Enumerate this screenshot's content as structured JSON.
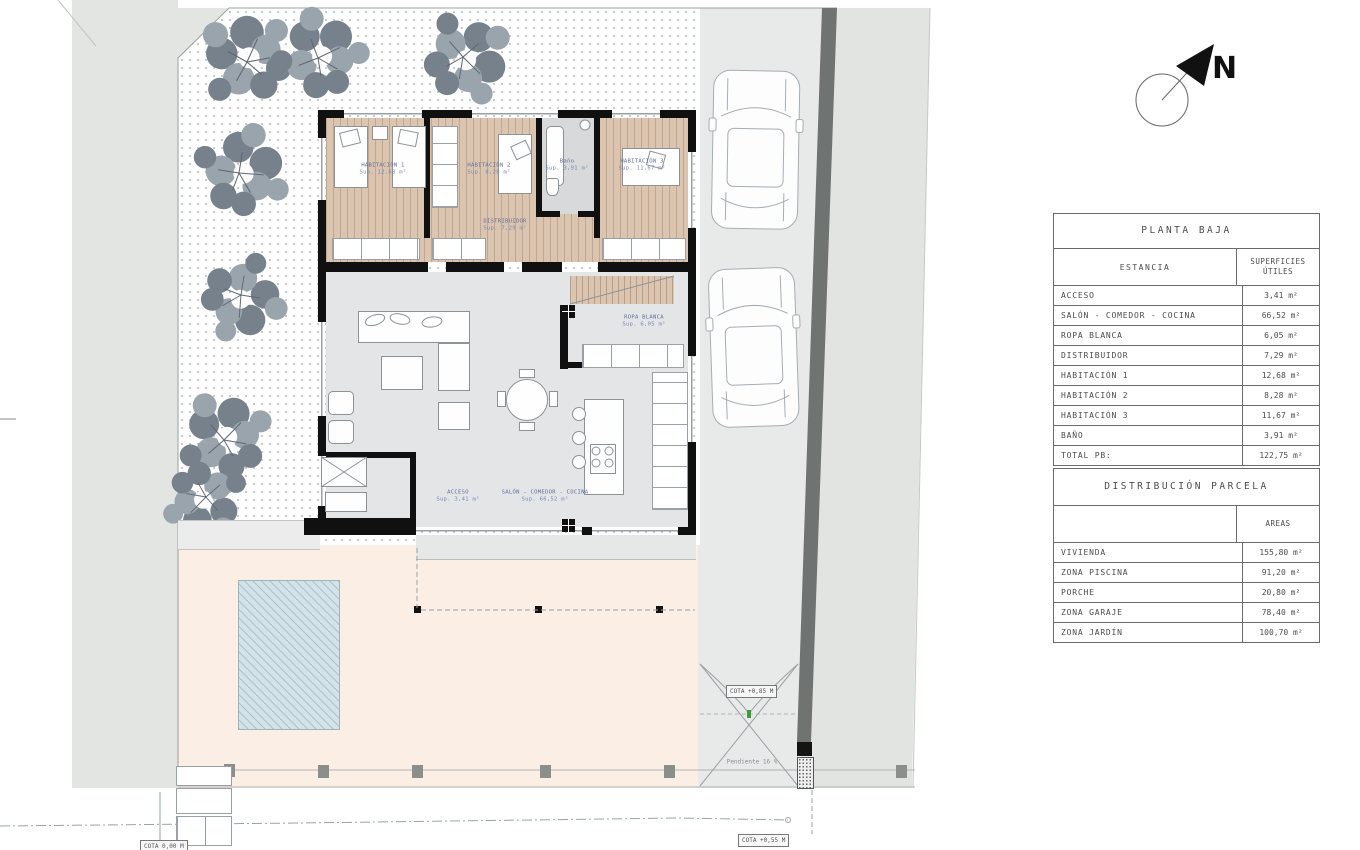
{
  "drawing": {
    "north_label": "N",
    "room_labels": [
      {
        "name": "HABITACIÓN 1",
        "area": "Sup. 12,68 m²",
        "x": 383,
        "y": 170
      },
      {
        "name": "HABITACIÓN 2",
        "area": "Sup. 8,28 m²",
        "x": 489,
        "y": 170
      },
      {
        "name": "Baño",
        "area": "Sup. 3,91 m²",
        "x": 567,
        "y": 166
      },
      {
        "name": "HABITACIÓN 3",
        "area": "Sup. 11,67 m²",
        "x": 642,
        "y": 166
      },
      {
        "name": "DISTRIBUIDOR",
        "area": "Sup. 7,29 m²",
        "x": 505,
        "y": 226
      },
      {
        "name": "ROPA BLANCA",
        "area": "Sup. 6,05 m²",
        "x": 644,
        "y": 322
      },
      {
        "name": "ACCESO",
        "area": "Sup. 3,41 m²",
        "x": 458,
        "y": 497
      },
      {
        "name": "SALÓN - COMEDOR - COCINA",
        "area": "Sup. 66,52 m²",
        "x": 545,
        "y": 497
      }
    ],
    "annotations": {
      "cota_gate": "COTA +0,85 M",
      "cota_street": "COTA +0,55 M",
      "cota_left": "COTA 0,00 M",
      "pendiente": "Pendiente 16 %"
    }
  },
  "tables": {
    "planta_baja": {
      "title": "PLANTA BAJA",
      "col1_header": "ESTANCIA",
      "col2_header": "SUPERFICIES ÚTILES",
      "rows": [
        [
          "ACCESO",
          "3,41 m²"
        ],
        [
          "SALÓN - COMEDOR - COCINA",
          "66,52 m²"
        ],
        [
          "ROPA BLANCA",
          "6,05 m²"
        ],
        [
          "DISTRIBUIDOR",
          "7,29 m²"
        ],
        [
          "HABITACIÓN 1",
          "12,68 m²"
        ],
        [
          "HABITACIÓN 2",
          "8,28 m²"
        ],
        [
          "HABITACIÓN 3",
          "11,67 m²"
        ],
        [
          "BAÑO",
          "3,91 m²"
        ],
        [
          "TOTAL PB:",
          "122,75 m²"
        ]
      ]
    },
    "distribucion_parcela": {
      "title": "DISTRIBUCIÓN PARCELA",
      "col1_header": "",
      "col2_header": "AREAS",
      "rows": [
        [
          "VIVIENDA",
          "155,80 m²"
        ],
        [
          "ZONA PISCINA",
          "91,20 m²"
        ],
        [
          "PORCHE",
          "20,80 m²"
        ],
        [
          "ZONA GARAJE",
          "78,40 m²"
        ],
        [
          "ZONA JARDÍN",
          "100,70 m²"
        ]
      ]
    }
  },
  "colors": {
    "wood_floor": "#dbc5b0",
    "living_floor": "#e3e5e6",
    "terrace": "#fbeee5",
    "pool": "#d3e3e7",
    "garden_dot": "#b3b8c2",
    "driveway": "#e8e9e9",
    "boundary_wall": "#6f7372",
    "wall": "#101010",
    "label_blue": "#7787b8"
  }
}
